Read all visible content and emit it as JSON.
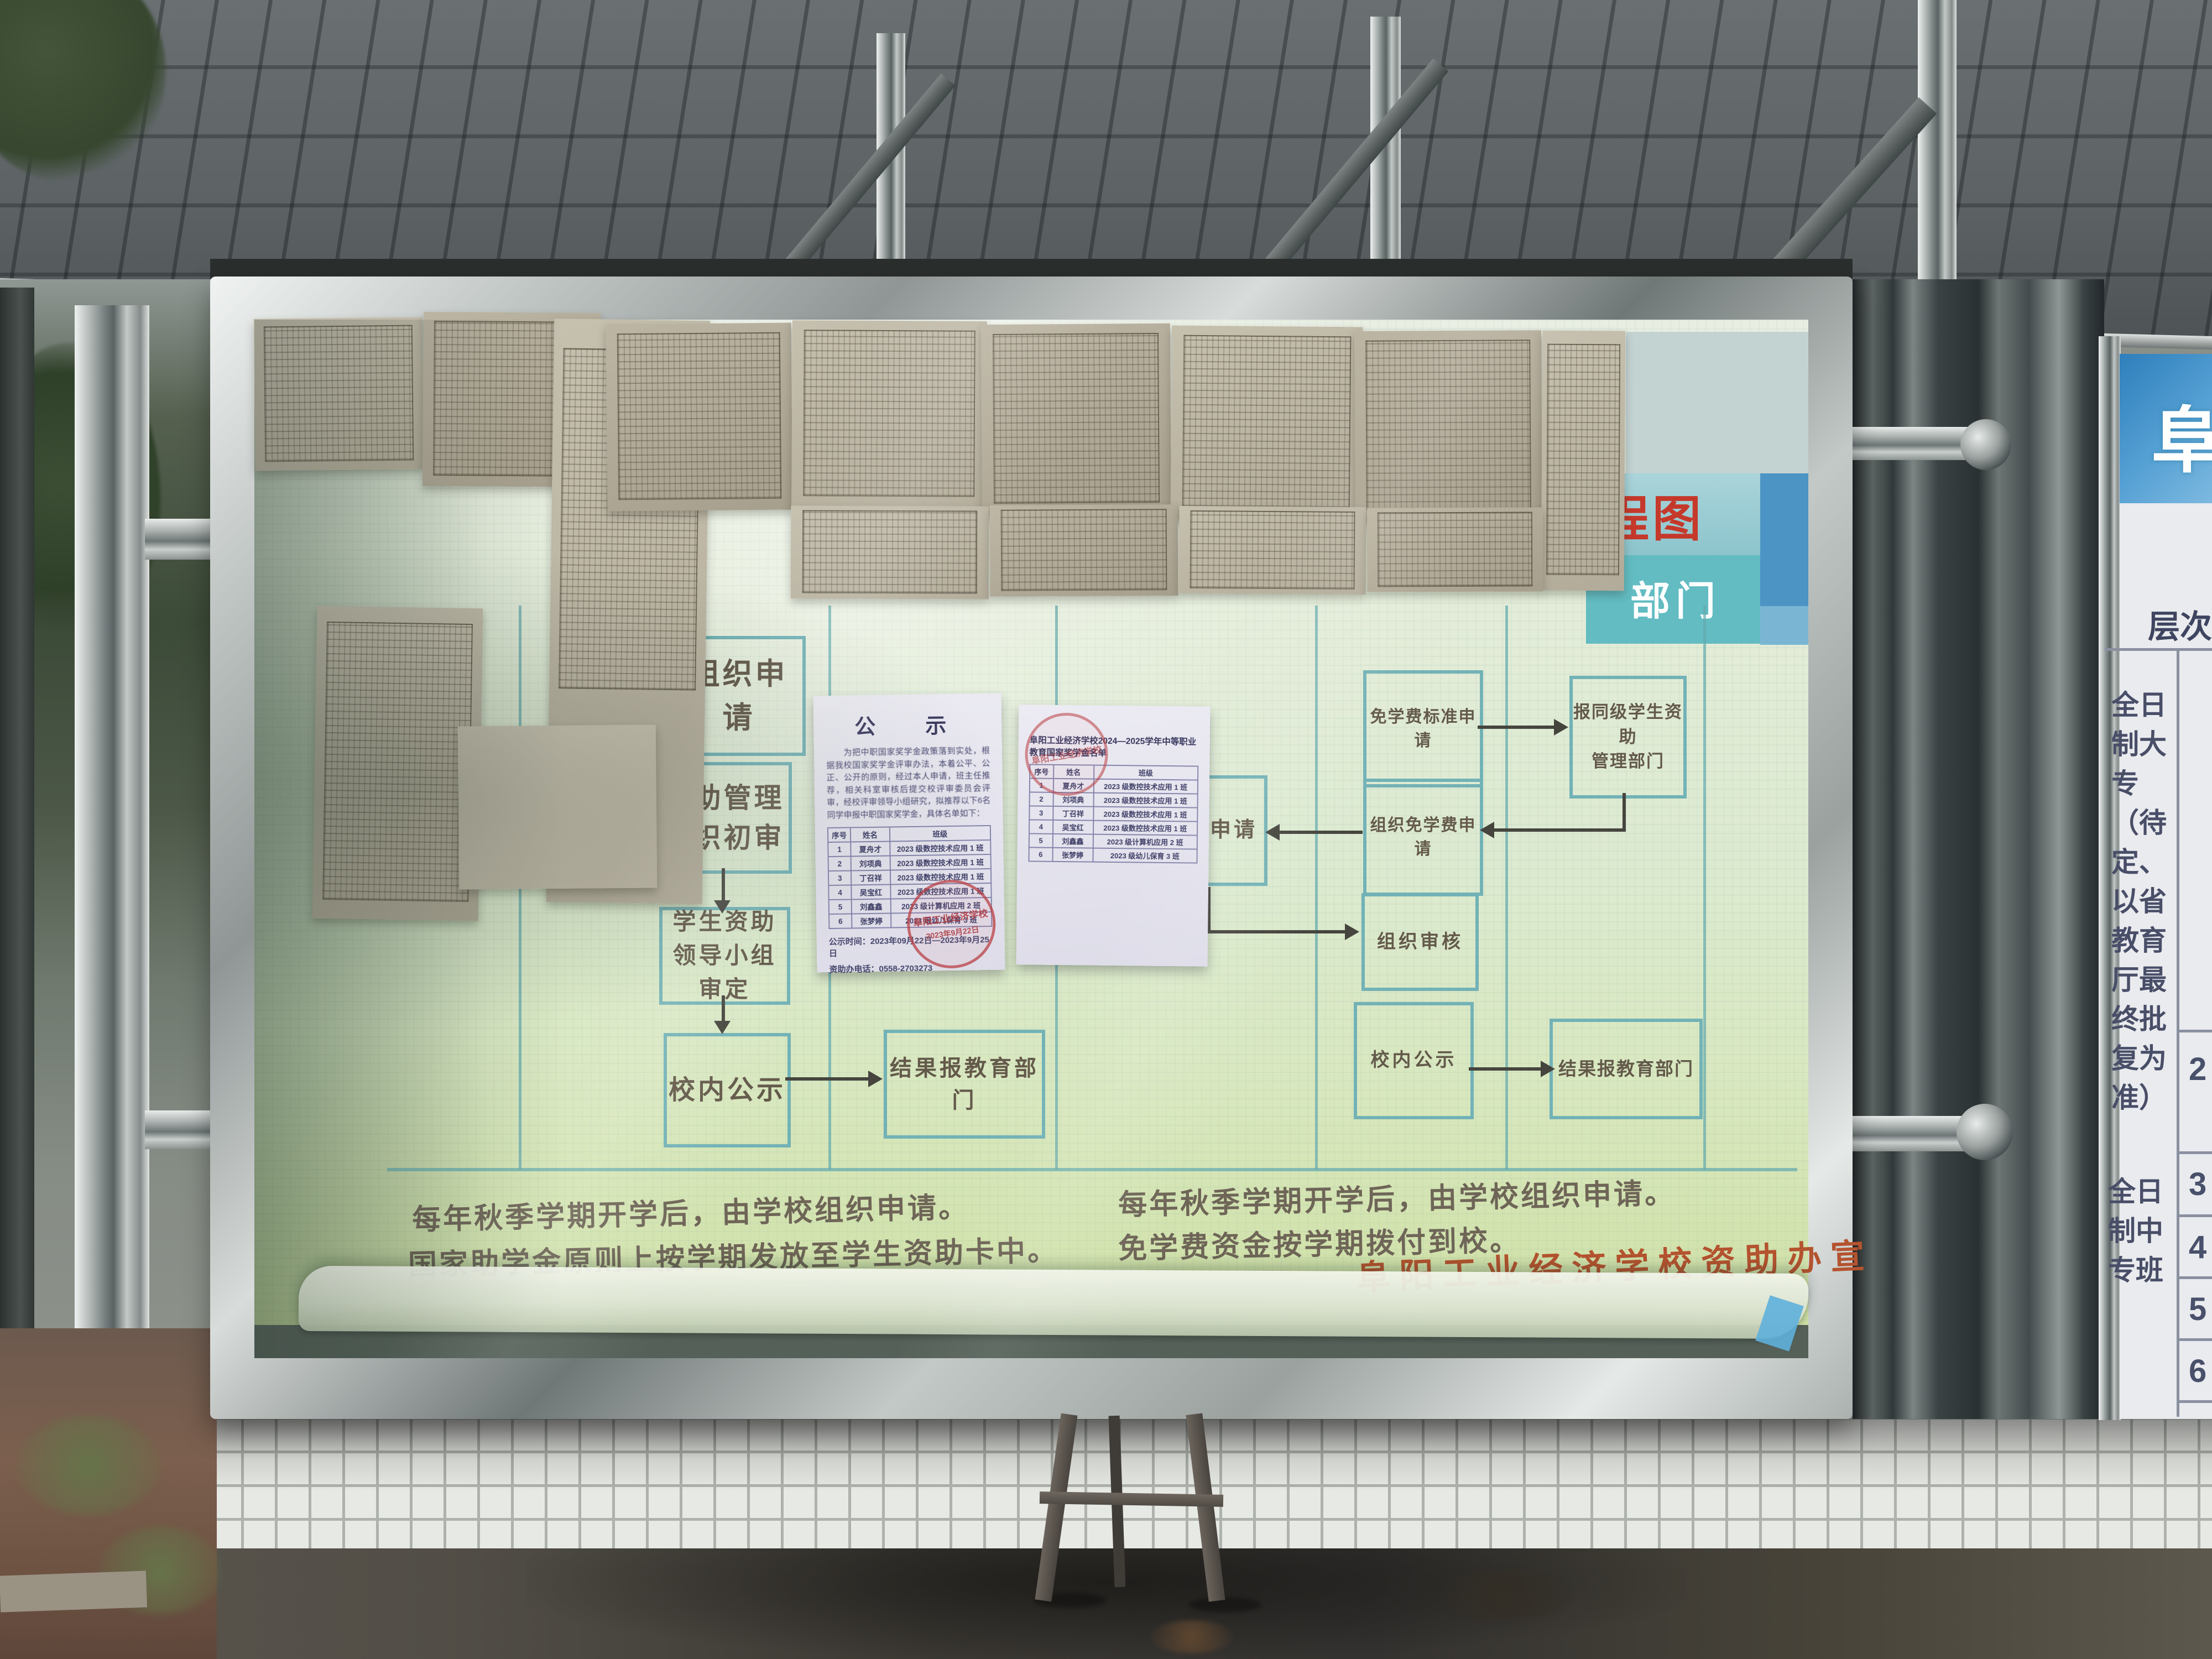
{
  "poster": {
    "header": {
      "red_title_fragment": "程图",
      "column_label": "部门"
    },
    "flow_left": {
      "boxes": [
        "组织申请",
        "资助管理\n组织初审",
        "学生资助\n领导小组审定",
        "校内公示",
        "结果报教育部门"
      ],
      "notes": [
        "每年秋季学期开学后，由学校组织申请。",
        "国家助学金原则上按学期发放至学生资助卡中。"
      ]
    },
    "flow_right": {
      "boxes": [
        "免学费标准申请",
        "报同级学生资助\n管理部门",
        "组织免学费申请",
        "提交申请",
        "组织审核",
        "校内公示",
        "结果报教育部门"
      ],
      "notes": [
        "每年秋季学期开学后，由学校组织申请。",
        "免学费资金按学期拨付到校。"
      ]
    },
    "signature": "阜阳工业经济学校资助办宣"
  },
  "notice": {
    "title": "公　示",
    "body": "为把中职国家奖学金政策落到实处，根据我校国家奖学金评审办法，本着公平、公正、公开的原则，经过本人申请，班主任推荐，相关科室审核后提交校评审委员会评审，经校评审领导小组研究，拟推荐以下6名同学申报中职国家奖学金，具体名单如下：",
    "table": {
      "headers": [
        "序号",
        "姓名",
        "班级"
      ],
      "rows": [
        [
          "1",
          "夏舟才",
          "2023 级数控技术应用 1 班"
        ],
        [
          "2",
          "刘项典",
          "2023 级数控技术应用 1 班"
        ],
        [
          "3",
          "丁召祥",
          "2023 级数控技术应用 1 班"
        ],
        [
          "4",
          "吴宝红",
          "2023 级数控技术应用 1 班"
        ],
        [
          "5",
          "刘鑫鑫",
          "2023 级计算机应用 2 班"
        ],
        [
          "6",
          "张梦婷",
          "2023 级幼儿保育 3 班"
        ]
      ]
    },
    "time_line": "公示时间：2023年09月22日—2023年9月25日",
    "phone_line": "资助办电话：0558-2703273",
    "stamp_school": "阜阳工业经济学校",
    "stamp_date": "2023年9月22日"
  },
  "roster": {
    "title": "阜阳工业经济学校2024—2025学年中等职业教育国家奖学金名单",
    "headers": [
      "序号",
      "姓名",
      "班级"
    ],
    "rows": [
      [
        "1",
        "夏舟才",
        "2023 级数控技术应用 1 班"
      ],
      [
        "2",
        "刘项典",
        "2023 级数控技术应用 1 班"
      ],
      [
        "3",
        "丁召祥",
        "2023 级数控技术应用 1 班"
      ],
      [
        "4",
        "吴宝红",
        "2023 级数控技术应用 1 班"
      ],
      [
        "5",
        "刘鑫鑫",
        "2023 级计算机应用 2 班"
      ],
      [
        "6",
        "张梦婷",
        "2023 级幼儿保育 3 班"
      ]
    ],
    "stamp_school": "阜阳工业经济学校"
  },
  "side_board": {
    "sign_char": "阜",
    "header": "层次",
    "tier1": "全日制大专（待定、以省教育厅最终批复为准）",
    "tier2": "全日制中专班",
    "numbers": [
      "2",
      "3",
      "4",
      "5",
      "6"
    ]
  },
  "colors": {
    "poster_teal": "#72b2b6",
    "arrow": "#45453e",
    "title_red": "#c5392b",
    "signature_red": "#b4532f",
    "header_teal": "#62bcc2",
    "sign_blue": "#3a85c0"
  }
}
